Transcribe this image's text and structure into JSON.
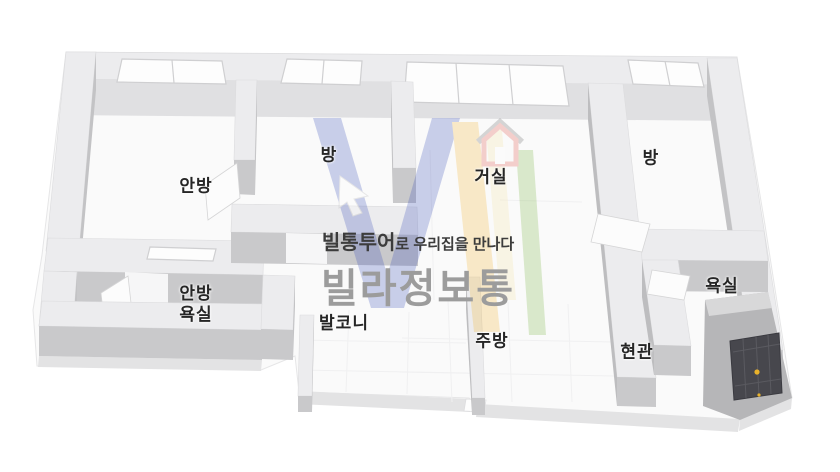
{
  "rooms": [
    {
      "id": "anbang",
      "label": "안방"
    },
    {
      "id": "bang-left",
      "label": "방"
    },
    {
      "id": "geosil",
      "label": "거실"
    },
    {
      "id": "bang-right",
      "label": "방"
    },
    {
      "id": "anbang-yoksil",
      "label": "안방\n욕실"
    },
    {
      "id": "balcony",
      "label": "발코니"
    },
    {
      "id": "jubang",
      "label": "주방"
    },
    {
      "id": "hyeongwan",
      "label": "현관"
    },
    {
      "id": "yoksil",
      "label": "욕실"
    }
  ],
  "watermark": {
    "tagline_brand": "빌통투어",
    "tagline_rest": "로 우리집을 만나다",
    "brand": "빌라정보통"
  },
  "colors": {
    "floor": "#fafafa",
    "slab-edge": "#e3e3e4",
    "wall-top": "#ececee",
    "wall-face": "#c9c9cb",
    "wall-side": "#c3c3c5",
    "door": "#47474d",
    "knob": "#e9b22b",
    "label": "#262626",
    "tagline-dark": "#3c3c3c",
    "brand-gray": "#9c9c9c",
    "logo-blue": "#3d52ba",
    "logo-yellow": "#f3b73a",
    "logo-pale": "#f6e5a8",
    "logo-green": "#7cb648",
    "logo-red": "#e0544a"
  }
}
